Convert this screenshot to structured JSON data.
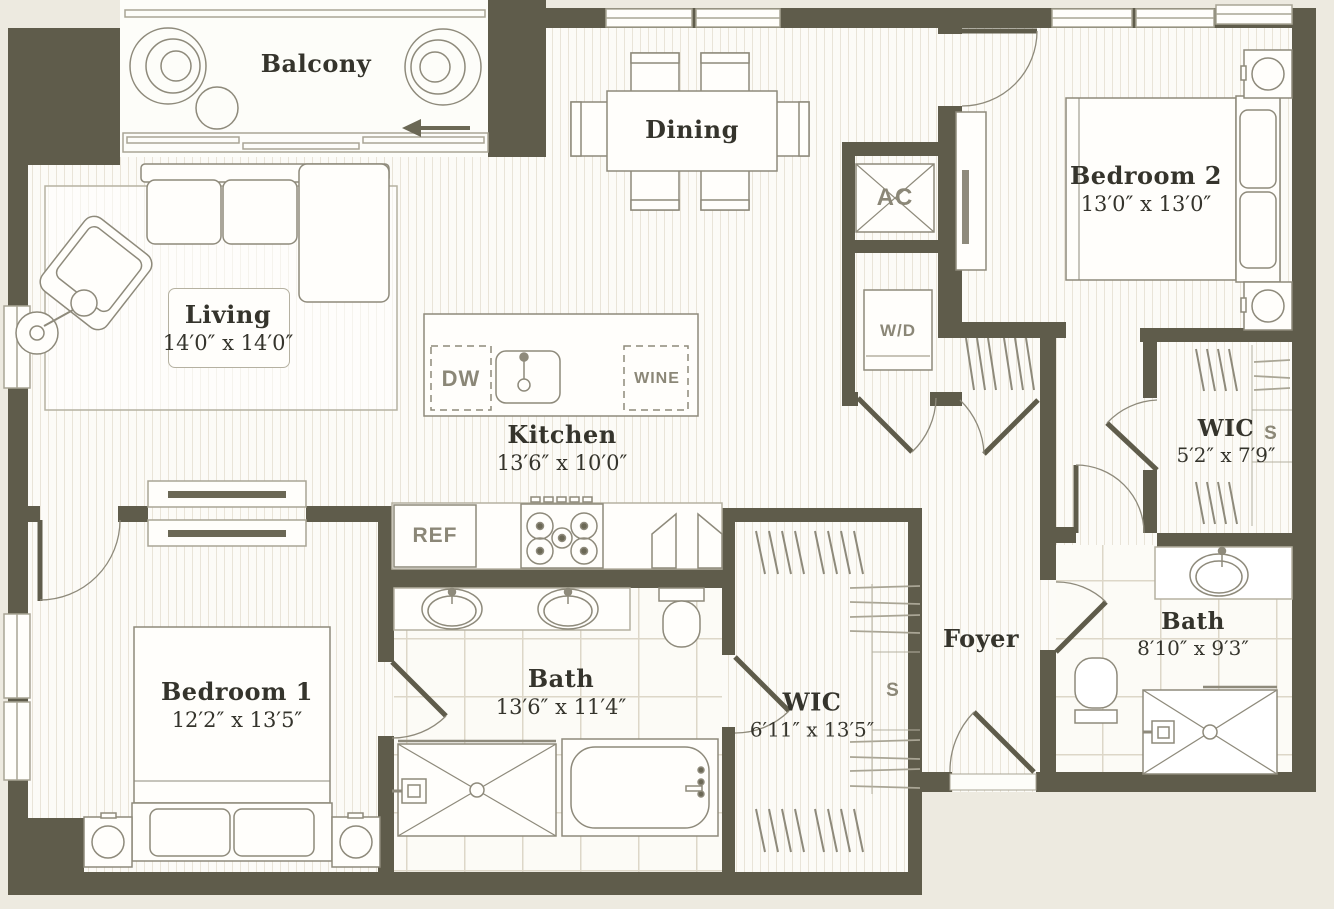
{
  "title": "Apartment floor plan",
  "colors": {
    "wall": "#5f5c4b",
    "outside": "#edeae0",
    "floor": "#fcfbf7",
    "furniture_line": "#8e8a7b",
    "label_text": "#35342c",
    "fixture_text": "#8b8777"
  },
  "rooms": {
    "balcony": {
      "name": "Balcony",
      "dims": ""
    },
    "living": {
      "name": "Living",
      "dims": "14′0″ x 14′0″"
    },
    "dining": {
      "name": "Dining",
      "dims": ""
    },
    "kitchen": {
      "name": "Kitchen",
      "dims": "13′6″ x 10′0″"
    },
    "bedroom2": {
      "name": "Bedroom 2",
      "dims": "13′0″ x 13′0″"
    },
    "wic_bedroom2": {
      "name": "WIC",
      "dims": "5′2″ x 7′9″"
    },
    "bedroom1": {
      "name": "Bedroom 1",
      "dims": "12′2″ x 13′5″"
    },
    "bath_main": {
      "name": "Bath",
      "dims": "13′6″ x 11′4″"
    },
    "wic_bedroom1": {
      "name": "WIC",
      "dims": "6′11″ x 13′5″"
    },
    "foyer": {
      "name": "Foyer",
      "dims": ""
    },
    "bath2": {
      "name": "Bath",
      "dims": "8′10″ x 9′3″"
    }
  },
  "fixtures": {
    "ac": "AC",
    "washer_dryer": "W/D",
    "dishwasher": "DW",
    "wine": "WINE",
    "refrigerator": "REF",
    "shelf_wic_bedroom1": "S",
    "shelf_wic_bedroom2": "S"
  }
}
